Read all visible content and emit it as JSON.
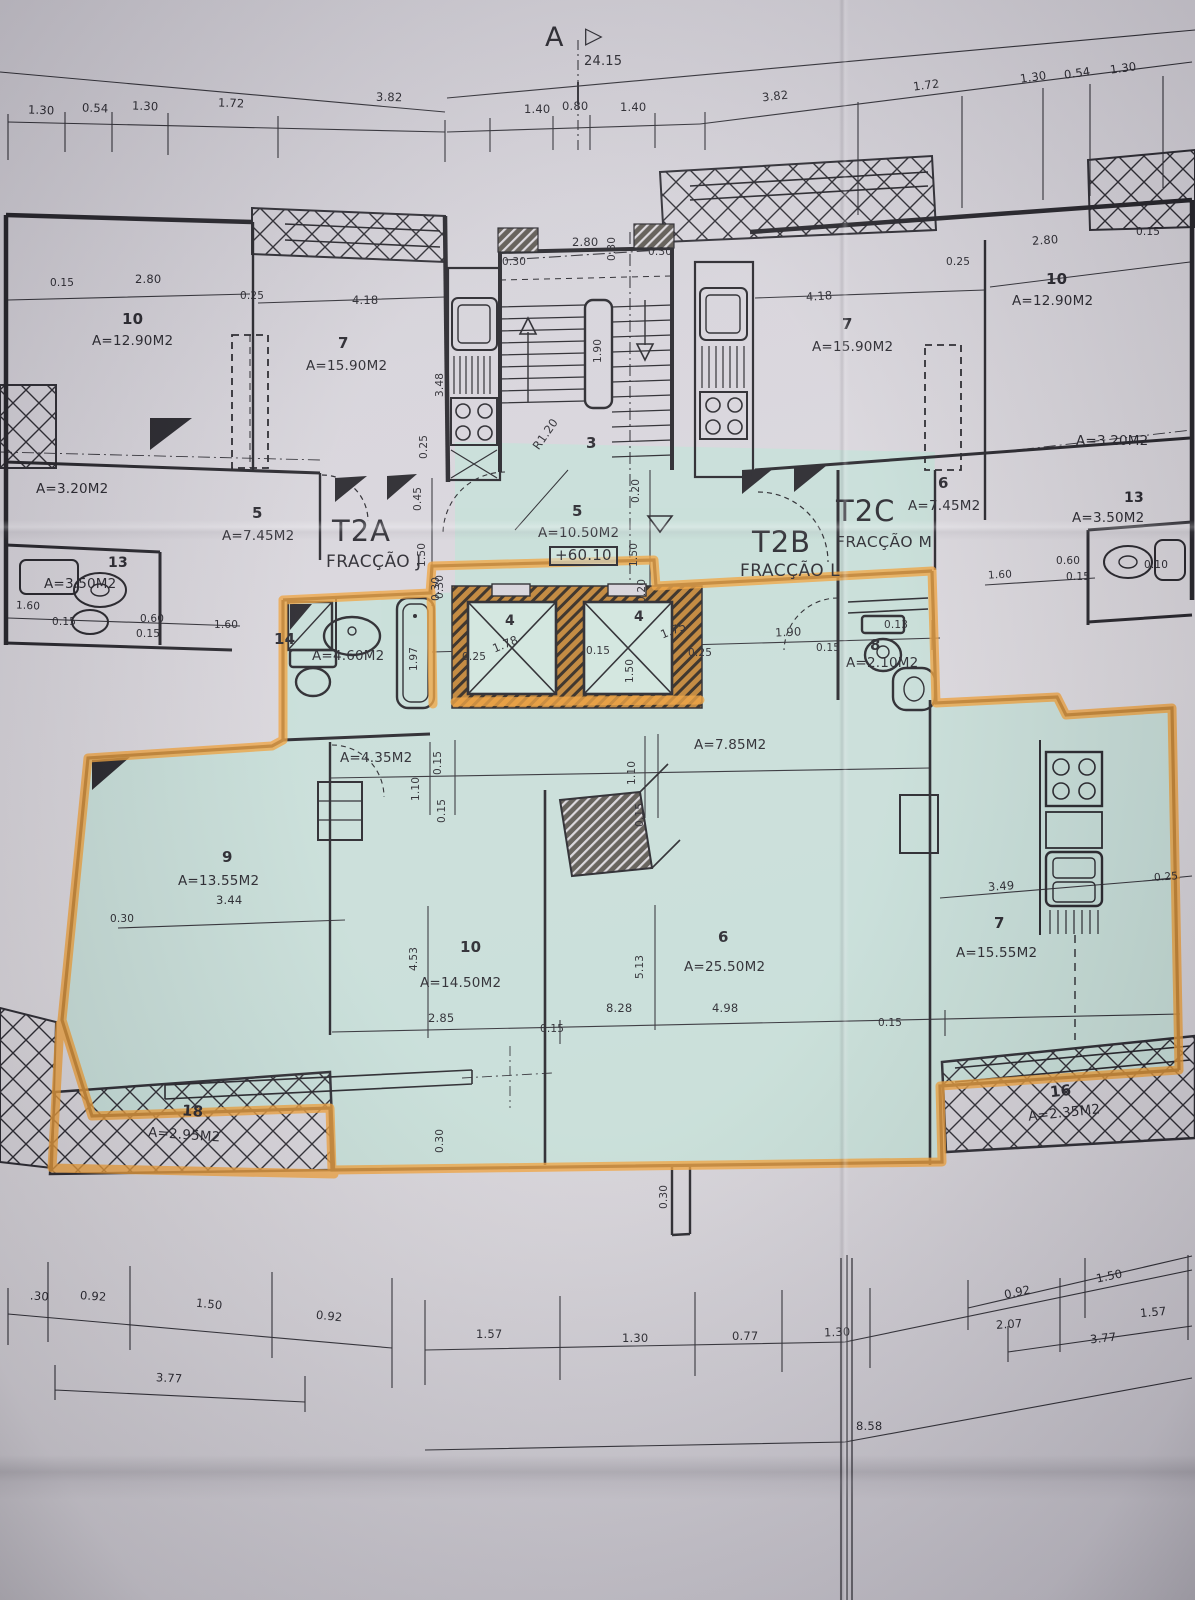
{
  "document": {
    "kind": "architectural floor plan photo",
    "highlighted_unit": "T2B"
  },
  "colors": {
    "paper": "#d5d2d9",
    "ink": "#201f26",
    "highlight_fill": "#c3ded6",
    "marker_orange": "#ef9d33",
    "wall_hatch_brown": "#bd7f2f"
  },
  "marker": {
    "letter": "A",
    "arrow": "▷",
    "total_dim": "24.15"
  },
  "elevation": "+60.10",
  "units": {
    "t2a": {
      "code": "T2A",
      "fraction": "FRACÇÃO J"
    },
    "t2b": {
      "code": "T2B",
      "fraction": "FRACÇÃO L"
    },
    "t2c": {
      "code": "T2C",
      "fraction": "FRACÇÃO M"
    }
  },
  "rooms": {
    "left_10": {
      "num": "10",
      "area": "A=12.90M2"
    },
    "left_7": {
      "num": "7",
      "area": "A=15.90M2"
    },
    "left_320": {
      "area": "A=3.20M2"
    },
    "left_5": {
      "num": "5",
      "area": "A=7.45M2"
    },
    "left_13": {
      "num": "13",
      "area": "A=3.50M2"
    },
    "stair_3": {
      "num": "3"
    },
    "landing_5": {
      "num": "5",
      "area": "A=10.50M2"
    },
    "right_7": {
      "num": "7",
      "area": "A=15.90M2"
    },
    "right_10": {
      "num": "10",
      "area": "A=12.90M2"
    },
    "right_320": {
      "area": "A=3.20M2"
    },
    "right_6": {
      "num": "6",
      "area": "A=7.45M2"
    },
    "right_13": {
      "num": "13",
      "area": "A=3.50M2"
    },
    "bath_14": {
      "num": "14",
      "area": "A=4.60M2"
    },
    "wc_8": {
      "num": "8",
      "area": "A=2.10M2"
    },
    "hall_435": {
      "area": "A=4.35M2"
    },
    "hall_785": {
      "area": "A=7.85M2"
    },
    "bed_9": {
      "num": "9",
      "area": "A=13.55M2"
    },
    "bed_10": {
      "num": "10",
      "area": "A=14.50M2"
    },
    "living_6": {
      "num": "6",
      "area": "A=25.50M2"
    },
    "kitchen_7": {
      "num": "7",
      "area": "A=15.55M2"
    },
    "balcony_18": {
      "num": "18",
      "area": "A=2.95M2"
    },
    "balcony_16": {
      "num": "16",
      "area": "A=2.35M2"
    },
    "elevator_a": {
      "num": "4"
    },
    "elevator_b": {
      "num": "4"
    }
  },
  "dims": {
    "top": [
      "1.30",
      "0.54",
      "1.30",
      "1.72",
      "3.82",
      "1.40",
      "0.80",
      "1.40",
      "3.82",
      "1.72",
      "1.30",
      "0.54",
      "1.30"
    ],
    "upper_left": [
      "0.15",
      "2.80",
      "0.25",
      "4.18",
      "3.48",
      "0.25"
    ],
    "left_edge": [
      "0.45",
      "1.50",
      "0.30",
      "1.60",
      "0.15",
      "0.60",
      "0.15",
      "1.60"
    ],
    "core": [
      "2.80",
      "0.30",
      "0.30",
      "0.30",
      "1.90",
      "R1.20",
      "0.20",
      "1.50",
      "0.20"
    ],
    "upper_right": [
      "4.18",
      "0.25",
      "2.80",
      "0.15"
    ],
    "right_edge": [
      "1.60",
      "0.60",
      "0.15",
      "0.10"
    ],
    "bath": [
      "1.97",
      "0.30"
    ],
    "elev_row": [
      "0.25",
      "1.78",
      "0.15",
      "1.50",
      "1.75",
      "0.25",
      "1.90",
      "0.15",
      "0.13"
    ],
    "hall": [
      "1.10",
      "0.15",
      "0.15",
      "1.10",
      "0.15"
    ],
    "rooms": [
      "3.44",
      "0.30",
      "4.53",
      "2.85",
      "5.13",
      "8.28",
      "4.98",
      "0.15",
      "3.49",
      "0.25",
      "0.15"
    ],
    "stubs": [
      "0.30",
      "0.30"
    ],
    "bottom_a": [
      ".30",
      "0.92",
      "1.50",
      "0.92"
    ],
    "bottom_b": [
      "1.57",
      "1.30",
      "0.77",
      "1.30",
      "2.07",
      "1.57"
    ],
    "bottom_c": [
      "0.92",
      "1.50"
    ],
    "bottom_d": [
      "3.77",
      "8.58",
      "3.77"
    ]
  }
}
